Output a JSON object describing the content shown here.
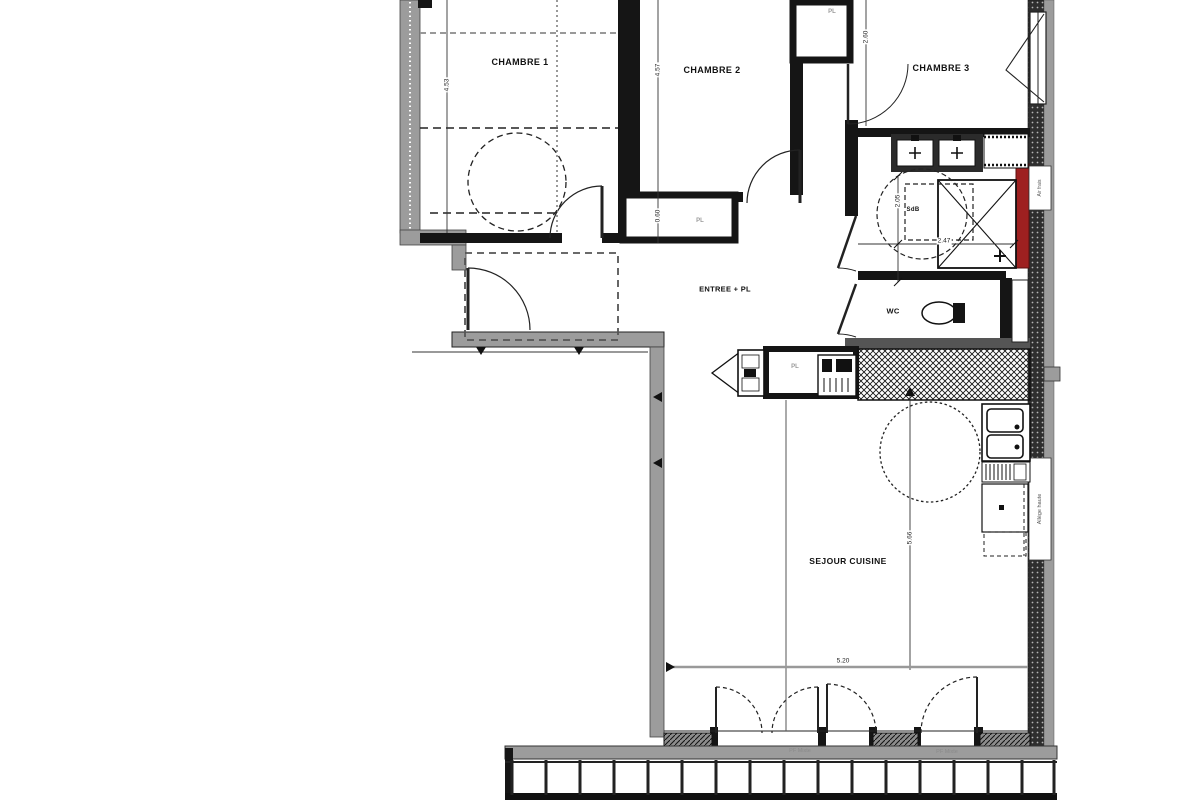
{
  "plan": {
    "rooms": {
      "chambre1": "CHAMBRE 1",
      "chambre2": "CHAMBRE 2",
      "chambre3": "CHAMBRE 3",
      "entree": "ENTREE + PL",
      "wc": "WC",
      "sdb": "SdB",
      "sejour": "SEJOUR CUISINE",
      "pl_top": "PL",
      "pl_hall": "PL",
      "pl_kitchen": "PL"
    },
    "dimensions": {
      "chambre1_depth": "4.53",
      "chambre2_depth": "4.57",
      "chambre3_width": "2.60",
      "pl_hall_depth": "0.60",
      "sdb_depth": "2.05",
      "sdb_width": "2.47",
      "sejour_depth": "5.66",
      "sejour_width": "5.20"
    },
    "annotations": {
      "window_label_low": "Allège haute",
      "vent_label": "Air frais",
      "door_label_left": "PF Mixte",
      "door_label_right": "PF Mixte"
    },
    "colors": {
      "wall_black": "#151515",
      "concrete_grey": "#9c9c9c",
      "accent_red": "#9e2020",
      "background": "#ffffff"
    }
  }
}
